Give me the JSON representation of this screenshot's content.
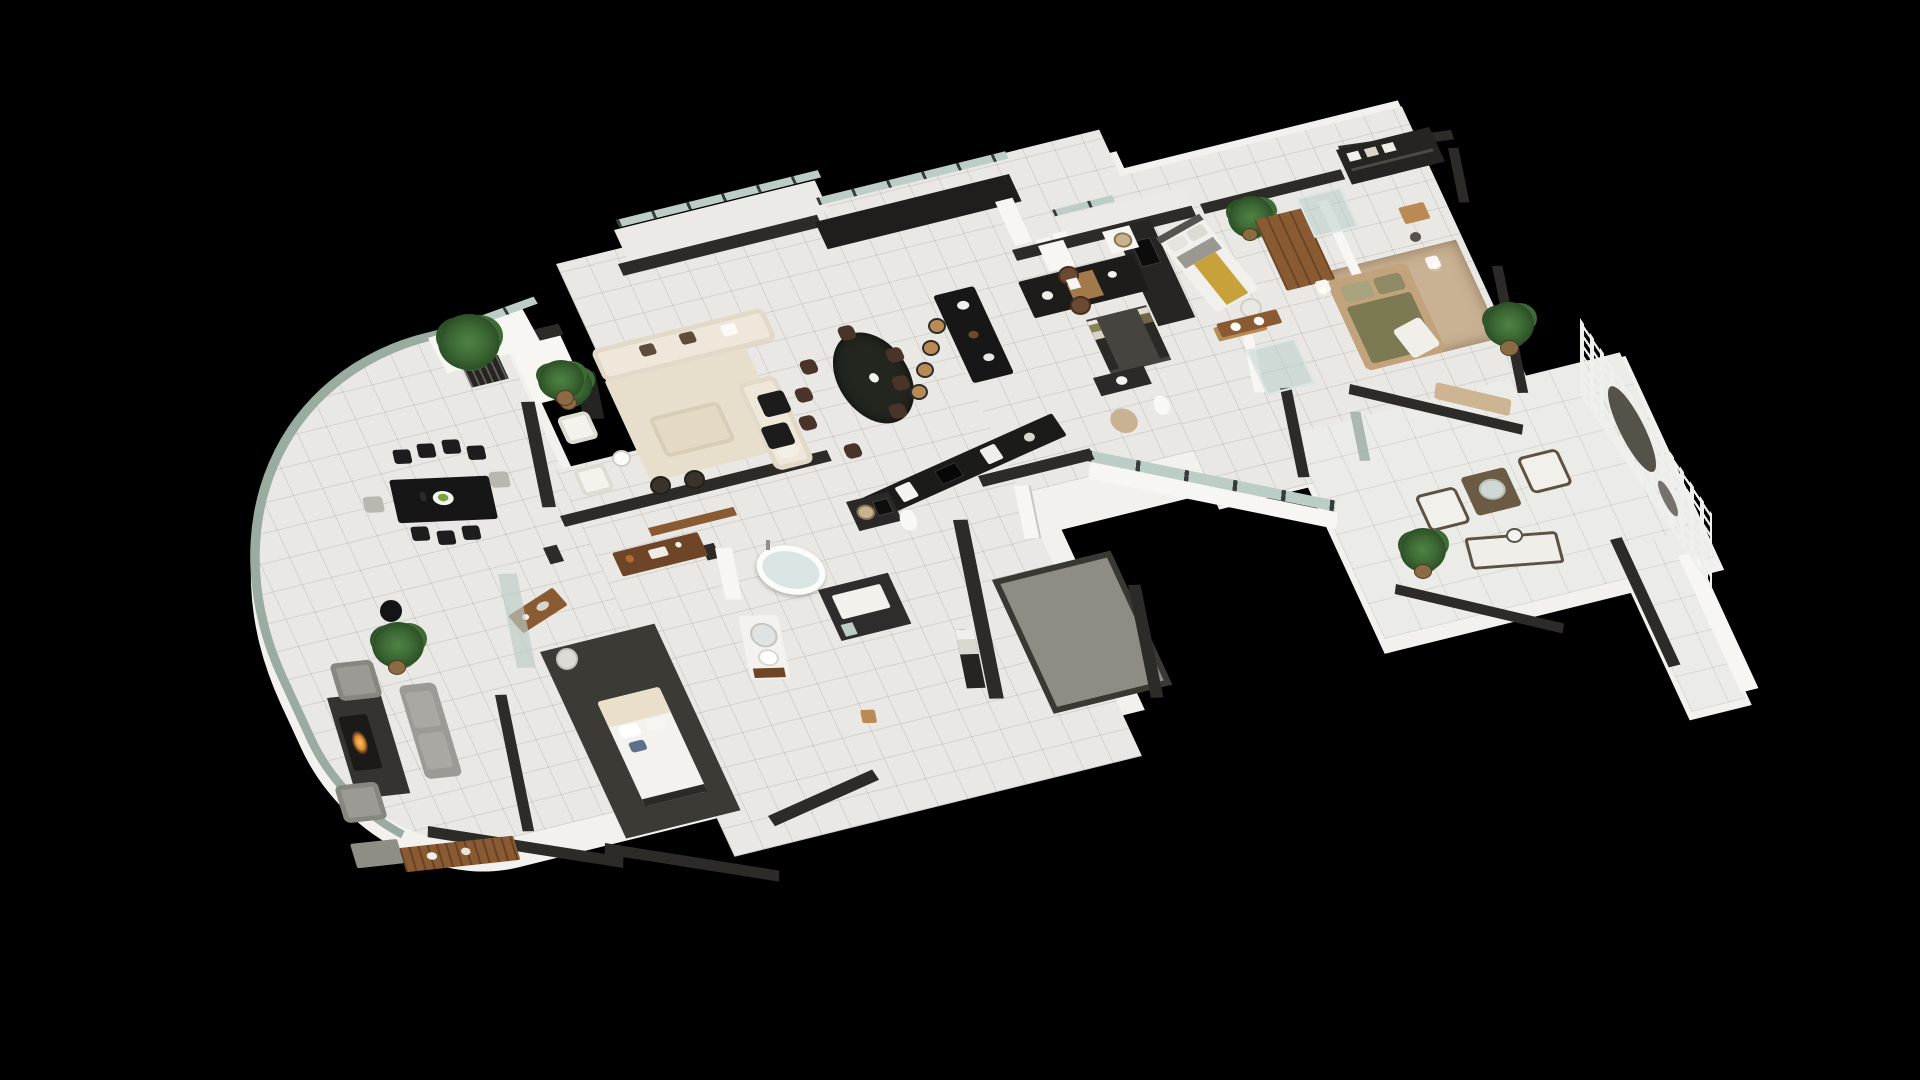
{
  "scene": {
    "type": "3d-floor-plan-render",
    "projection": "isometric",
    "background": "black",
    "description": "Top-down 3D rendering of a luxury apartment floor plan with a curved glass facade on the left, open living/dining/kitchen in the middle, two bedrooms with ensuite bathrooms on the right wing, a master suite and bathroom at the bottom center, and an outdoor terrace with a perforated privacy screen at the far right"
  },
  "palette": {
    "bg": "#000000",
    "slab": "#f2f1ed",
    "floor": "#e9e8e4",
    "terrace-floor": "#ebebe7",
    "wall-dark": "#2c2b28",
    "wall-black": "#1f1e1c",
    "wall-white": "#f7f6f3",
    "glass": "#9aab9f",
    "glass-light": "#bccdc6",
    "carpet-dark": "#3b3a35",
    "gray-room": "#8f8c85",
    "wood": "#8a5a33",
    "wood-dark": "#6e4526",
    "wood-light": "#b98a54",
    "black-furniture": "#161616",
    "cream": "#efe8da",
    "cream-dark": "#e3d9c5",
    "sofa-gray": "#9b9a94",
    "mustard": "#c9a13b",
    "olive": "#7b7a52",
    "sage": "#a8a27e",
    "tan": "#c9b193",
    "rug-beige": "#e7dfcc",
    "plant": "#3e6b35",
    "plant-dark": "#2e5228",
    "flame": "#e08b31",
    "water": "#d8e5e4",
    "screen": "#efefeb",
    "screen-hole": "#55524a",
    "pillow-blue": "#5e718a",
    "pillow-brown": "#5f4c39",
    "leather": "#4a342a"
  },
  "areas": [
    {
      "name": "curved-lounge",
      "furniture": [
        "rectangular-dining-table-for-eight",
        "black-dining-chairs",
        "gray-end-chairs",
        "serving-plate",
        "sculpture-pedestal",
        "floor-plant",
        "gray-armchairs",
        "gray-sofa",
        "fire-table",
        "dark-rug",
        "tv-cabinet",
        "slatted-wood-sideboard",
        "writing-desk",
        "desk-chair"
      ]
    },
    {
      "name": "curved-balcony",
      "furniture": [
        "glass-railing",
        "planter-box",
        "potted-palm"
      ]
    },
    {
      "name": "living-room",
      "furniture": [
        "cream-l-shaped-sectional",
        "brown-pillows",
        "cream-ottoman",
        "round-dark-stools",
        "white-metal-armchairs",
        "round-side-table",
        "beige-rug",
        "black-director-chairs",
        "dark-media-cabinet",
        "basket-plant"
      ]
    },
    {
      "name": "living-balcony",
      "furniture": [
        "glass-railing",
        "ac-units"
      ]
    },
    {
      "name": "dining-area",
      "furniture": [
        "black-oval-table-for-eight",
        "brown-leather-chairs",
        "flower-vase"
      ]
    },
    {
      "name": "kitchen",
      "furniture": [
        "black-island",
        "wood-bar-stools",
        "back-counter-with-shelves",
        "cooktop-counter",
        "white-appliances",
        "fridge",
        "leather-nook-chairs",
        "white-cube-table"
      ]
    },
    {
      "name": "bedroom-1",
      "furniture": [
        "double-bed-with-mustard-runner",
        "dark-media-wall",
        "wall-tv",
        "white-cabinet-with-basket",
        "wood-dresser",
        "white-chair",
        "potted-plant"
      ]
    },
    {
      "name": "walk-in-closet",
      "furniture": [
        "hanging-clothes-racks",
        "dark-floor"
      ]
    },
    {
      "name": "ensuite-bathroom",
      "furniture": [
        "dark-vanity",
        "toilet",
        "round-jute-rug",
        "wood-vanity-two-sinks",
        "glass-shower"
      ]
    },
    {
      "name": "bedroom-2",
      "furniture": [
        "king-bed-olive-duvet",
        "tan-bed-frame",
        "nightstands-with-lamps",
        "shaggy-tan-rug",
        "wardrobe-shelving-with-clothes",
        "small-desk-and-stool",
        "tall-wood-wardrobe",
        "window-bench",
        "glass-shower-room",
        "potted-plant"
      ]
    },
    {
      "name": "family-bathroom",
      "furniture": [
        "freestanding-oval-tub",
        "wood-console-with-decor",
        "wall-ledge",
        "white-vanity-round-mirror",
        "laundry-counter-with-basket",
        "toilet",
        "dark-cabinets-white-top",
        "towel-shelf"
      ]
    },
    {
      "name": "master-bedroom",
      "furniture": [
        "white-canopy-bed",
        "blue-accent-pillow",
        "charcoal-rug",
        "writing-desk",
        "swivel-chair",
        "glass-partition"
      ]
    },
    {
      "name": "utility-gray-room",
      "furniture": []
    },
    {
      "name": "hallway-entry",
      "furniture": [
        "open-white-door",
        "glass-door-to-terrace",
        "south-window-band"
      ]
    },
    {
      "name": "terrace",
      "furniture": [
        "wicker-coffee-table-glass-bowl",
        "white-lounge-chairs",
        "outdoor-sofa",
        "side-table",
        "potted-plants",
        "perforated-privacy-screen-with-circles",
        "parapet-walls",
        "entry-walkway"
      ]
    }
  ]
}
